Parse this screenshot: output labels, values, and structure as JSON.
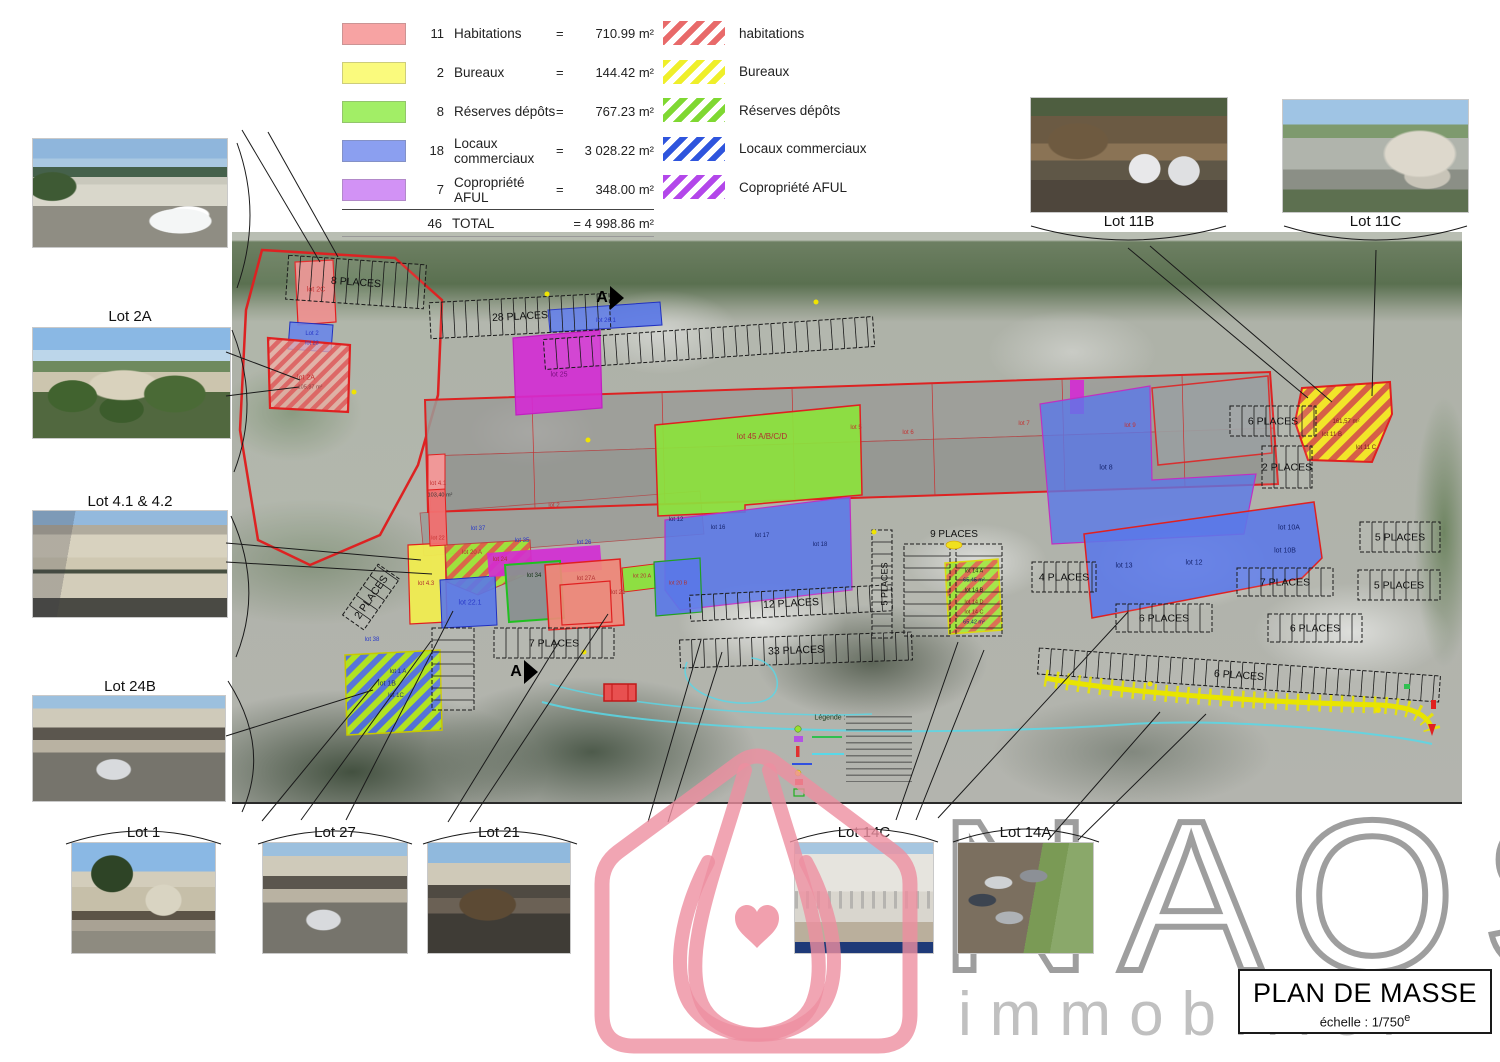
{
  "legend": {
    "rows": [
      {
        "count": "11",
        "label": "Habitations",
        "eq": "=",
        "value": "710.99 m²",
        "color": "#f7a3a3"
      },
      {
        "count": "2",
        "label": "Bureaux",
        "eq": "=",
        "value": "144.42 m²",
        "color": "#fafa7d"
      },
      {
        "count": "8",
        "label": "Réserves dépôts",
        "eq": "=",
        "value": "767.23 m²",
        "color": "#a2ee66"
      },
      {
        "count": "18",
        "label": "Locaux commerciaux",
        "eq": "=",
        "value": "3 028.22 m²",
        "color": "#8b9ff0"
      },
      {
        "count": "7",
        "label": "Copropriété AFUL",
        "eq": "=",
        "value": "348.00 m²",
        "color": "#d292f5"
      }
    ],
    "total": {
      "count": "46",
      "label": "TOTAL",
      "value": "= 4 998.86 m²"
    }
  },
  "hatch_legend": {
    "rows": [
      {
        "label": "habitations",
        "color": "#e86a6a"
      },
      {
        "label": "Bureaux",
        "color": "#efef2a"
      },
      {
        "label": "Réserves dépôts",
        "color": "#7fd832"
      },
      {
        "label": "Locaux commerciaux",
        "color": "#2f55dd"
      },
      {
        "label": "Copropriété AFUL",
        "color": "#b347ea"
      }
    ]
  },
  "photos": {
    "left": [
      "Lot 2A",
      "Lot 4.1 & 4.2",
      "Lot 24B"
    ],
    "top_right": [
      "Lot 11B",
      "Lot 11C"
    ],
    "bottom": [
      "Lot 1",
      "Lot 27",
      "Lot 21",
      "Lot 14C",
      "Lot 14A"
    ]
  },
  "plan": {
    "labels": [
      {
        "t": "lot 2C",
        "x": 84,
        "y": 58,
        "c": "#c43030",
        "s": 7
      },
      {
        "t": "Lot 2",
        "x": 80,
        "y": 102,
        "c": "#2838c8",
        "s": 6
      },
      {
        "t": "lot 23",
        "x": 80,
        "y": 112,
        "c": "#2838c8",
        "s": 5.5
      },
      {
        "t": "lot 2A",
        "x": 74,
        "y": 146,
        "c": "#c43030",
        "s": 7
      },
      {
        "t": "105,87 m²",
        "x": 78,
        "y": 156,
        "c": "#8a4040",
        "s": 5.5
      },
      {
        "t": "lot 25",
        "x": 327,
        "y": 143,
        "c": "#7a1080",
        "s": 7
      },
      {
        "t": "lot 26.1",
        "x": 374,
        "y": 89,
        "c": "#2838c8",
        "s": 6
      },
      {
        "t": "lot 45 A/B/C/D",
        "x": 530,
        "y": 205,
        "c": "#b03030",
        "s": 8
      },
      {
        "t": "lot 4.1",
        "x": 206,
        "y": 252,
        "c": "#c43030",
        "s": 6
      },
      {
        "t": "103,40 m²",
        "x": 208,
        "y": 264,
        "c": "#333333",
        "s": 5.5
      },
      {
        "t": "lot 22",
        "x": 206,
        "y": 307,
        "c": "#c43030",
        "s": 5.5
      },
      {
        "t": "lot 37",
        "x": 246,
        "y": 297,
        "c": "#2838c8",
        "s": 6
      },
      {
        "t": "lot 35",
        "x": 290,
        "y": 309,
        "c": "#2838c8",
        "s": 6
      },
      {
        "t": "lot 26",
        "x": 352,
        "y": 311,
        "c": "#2838c8",
        "s": 6
      },
      {
        "t": "lot 2",
        "x": 322,
        "y": 274,
        "c": "#c43030",
        "s": 6
      },
      {
        "t": "lot 34",
        "x": 302,
        "y": 344,
        "c": "#143014",
        "s": 6
      },
      {
        "t": "lot 27A",
        "x": 354,
        "y": 347,
        "c": "#b03030",
        "s": 6
      },
      {
        "t": "lot 21",
        "x": 386,
        "y": 361,
        "c": "#b03030",
        "s": 6
      },
      {
        "t": "lot 20 A",
        "x": 410,
        "y": 345,
        "c": "#b03030",
        "s": 5.5
      },
      {
        "t": "lot 20 B",
        "x": 446,
        "y": 352,
        "c": "#b03030",
        "s": 5.5
      },
      {
        "t": "lot 22.1",
        "x": 238,
        "y": 371,
        "c": "#2838c8",
        "s": 7
      },
      {
        "t": "lot 20 A",
        "x": 240,
        "y": 321,
        "c": "#b03030",
        "s": 6
      },
      {
        "t": "lot 24",
        "x": 268,
        "y": 328,
        "c": "#b03030",
        "s": 6
      },
      {
        "t": "lot 4.3",
        "x": 194,
        "y": 352,
        "c": "#b03030",
        "s": 6
      },
      {
        "t": "lot 38",
        "x": 140,
        "y": 408,
        "c": "#2838c8",
        "s": 6
      },
      {
        "t": "lot 1 A",
        "x": 166,
        "y": 440,
        "c": "#203070",
        "s": 6
      },
      {
        "t": "lot 1B",
        "x": 155,
        "y": 452,
        "c": "#203070",
        "s": 7
      },
      {
        "t": "lot 1C",
        "x": 164,
        "y": 464,
        "c": "#203070",
        "s": 6
      },
      {
        "t": "lot 12",
        "x": 444,
        "y": 288,
        "c": "#15246e",
        "s": 6
      },
      {
        "t": "lot 16",
        "x": 486,
        "y": 296,
        "c": "#15246e",
        "s": 6
      },
      {
        "t": "lot 17",
        "x": 530,
        "y": 304,
        "c": "#15246e",
        "s": 6
      },
      {
        "t": "lot 18",
        "x": 588,
        "y": 313,
        "c": "#15246e",
        "s": 6
      },
      {
        "t": "lot 5",
        "x": 624,
        "y": 196,
        "c": "#c43030",
        "s": 6
      },
      {
        "t": "lot 6",
        "x": 676,
        "y": 201,
        "c": "#c43030",
        "s": 6
      },
      {
        "t": "lot 7",
        "x": 792,
        "y": 192,
        "c": "#c43030",
        "s": 6
      },
      {
        "t": "lot 8",
        "x": 874,
        "y": 236,
        "c": "#15246e",
        "s": 7
      },
      {
        "t": "lot 9",
        "x": 898,
        "y": 194,
        "c": "#c43030",
        "s": 6
      },
      {
        "t": "lot 13",
        "x": 892,
        "y": 334,
        "c": "#15246e",
        "s": 7
      },
      {
        "t": "lot 12",
        "x": 962,
        "y": 331,
        "c": "#15246e",
        "s": 7
      },
      {
        "t": "lot 10A",
        "x": 1057,
        "y": 296,
        "c": "#15246e",
        "s": 7
      },
      {
        "t": "lot 10B",
        "x": 1053,
        "y": 319,
        "c": "#15246e",
        "s": 7
      },
      {
        "t": "lot 14 A",
        "x": 742,
        "y": 340,
        "c": "#143014",
        "s": 5.5
      },
      {
        "t": "65,45 m²",
        "x": 742,
        "y": 349,
        "c": "#15246e",
        "s": 5.5
      },
      {
        "t": "lot 14 B",
        "x": 742,
        "y": 359,
        "c": "#143014",
        "s": 5.5
      },
      {
        "t": "lot 14 D",
        "x": 742,
        "y": 371,
        "c": "#8a2020",
        "s": 5.5
      },
      {
        "t": "lot 14 C",
        "x": 742,
        "y": 381,
        "c": "#8a2020",
        "s": 5.5
      },
      {
        "t": "65,42 m²",
        "x": 742,
        "y": 391,
        "c": "#15246e",
        "s": 5.5
      },
      {
        "t": "161,57 m²",
        "x": 1114,
        "y": 190,
        "c": "#7a2020",
        "s": 6
      },
      {
        "t": "lot 11 B",
        "x": 1100,
        "y": 203,
        "c": "#7a2020",
        "s": 6
      },
      {
        "t": "lot 11 C",
        "x": 1134,
        "y": 216,
        "c": "#7a2020",
        "s": 6
      },
      {
        "t": "9 PLACES",
        "x": 722,
        "y": 303,
        "c": "#111111",
        "s": 10
      },
      {
        "t": "5 PLACES",
        "x": 653,
        "y": 352,
        "c": "#111111",
        "s": 9,
        "r": -90
      },
      {
        "t": "A",
        "x": 370,
        "y": 66,
        "c": "#000000",
        "s": 16
      },
      {
        "t": "A",
        "x": 284,
        "y": 440,
        "c": "#000000",
        "s": 16
      },
      {
        "t": "Légende :",
        "x": 598,
        "y": 486,
        "c": "#1a3a1a",
        "s": 7
      }
    ],
    "parking": [
      {
        "x": 55,
        "y": 28,
        "w": 138,
        "h": 44,
        "r": 4,
        "label": "8 PLACES"
      },
      {
        "x": 198,
        "y": 66,
        "w": 180,
        "h": 36,
        "r": -3,
        "label": "28 PLACES"
      },
      {
        "x": 312,
        "y": 96,
        "w": 330,
        "h": 30,
        "r": -4,
        "label": ""
      },
      {
        "x": 262,
        "y": 396,
        "w": 120,
        "h": 30,
        "r": 0,
        "label": "7 PLACES"
      },
      {
        "x": 448,
        "y": 404,
        "w": 232,
        "h": 28,
        "r": -2,
        "label": "33 PLACES"
      },
      {
        "x": 458,
        "y": 358,
        "w": 202,
        "h": 26,
        "r": -3,
        "label": "12 PLACES"
      },
      {
        "x": 672,
        "y": 312,
        "w": 46,
        "h": 92,
        "r": 0,
        "label": ""
      },
      {
        "x": 724,
        "y": 312,
        "w": 46,
        "h": 92,
        "r": 0,
        "label": ""
      },
      {
        "x": 640,
        "y": 298,
        "w": 20,
        "h": 108,
        "r": 0,
        "label": ""
      },
      {
        "x": 800,
        "y": 330,
        "w": 64,
        "h": 30,
        "r": 0,
        "label": "4 PLACES"
      },
      {
        "x": 884,
        "y": 372,
        "w": 96,
        "h": 28,
        "r": 0,
        "label": "6 PLACES"
      },
      {
        "x": 998,
        "y": 174,
        "w": 86,
        "h": 30,
        "r": 0,
        "label": "6 PLACES"
      },
      {
        "x": 1030,
        "y": 214,
        "w": 50,
        "h": 42,
        "r": 0,
        "label": "2 PLACES"
      },
      {
        "x": 1128,
        "y": 290,
        "w": 80,
        "h": 30,
        "r": 0,
        "label": "5 PLACES"
      },
      {
        "x": 1126,
        "y": 338,
        "w": 82,
        "h": 30,
        "r": 0,
        "label": "5 PLACES"
      },
      {
        "x": 1005,
        "y": 336,
        "w": 96,
        "h": 28,
        "r": 0,
        "label": "7 PLACES"
      },
      {
        "x": 1036,
        "y": 382,
        "w": 94,
        "h": 28,
        "r": 0,
        "label": "6 PLACES"
      },
      {
        "x": 108,
        "y": 352,
        "w": 62,
        "h": 26,
        "r": -55,
        "label": "2 PLACES"
      },
      {
        "x": 806,
        "y": 430,
        "w": 402,
        "h": 26,
        "r": 4,
        "label": "6 PLACES"
      },
      {
        "x": 200,
        "y": 396,
        "w": 42,
        "h": 82,
        "r": 0,
        "label": ""
      }
    ]
  },
  "watermark": {
    "brand": "NAOS",
    "tagline": "immobilier"
  },
  "title_block": {
    "title": "PLAN DE MASSE",
    "scale": "échelle : 1/750",
    "scale_sup": "e"
  }
}
